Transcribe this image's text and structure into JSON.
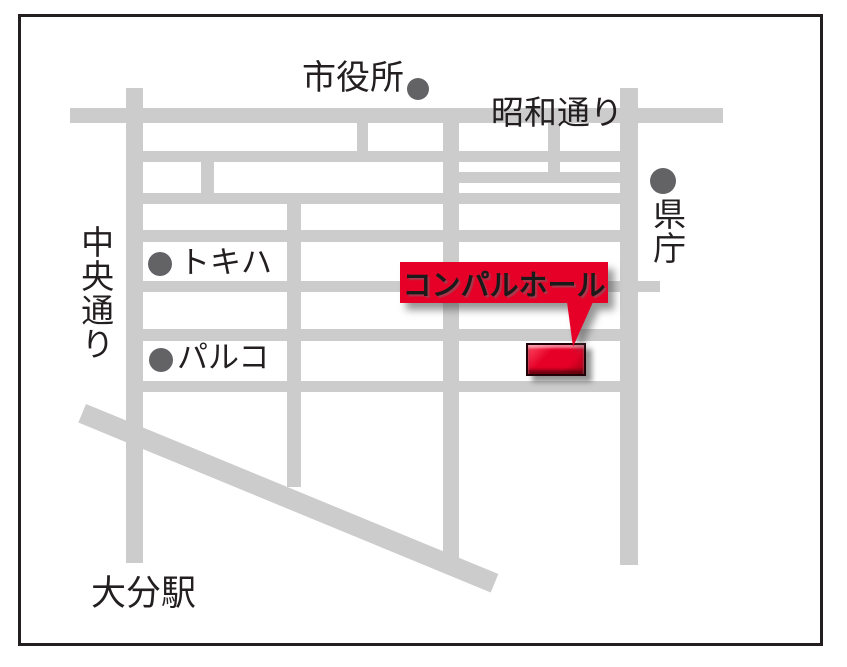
{
  "map": {
    "labels": {
      "city_hall": "市役所",
      "showa_dori": "昭和通り",
      "prefectural_office": "県庁",
      "chuo_dori": "中央通り",
      "tokiwa": "トキハ",
      "parco": "パルコ",
      "destination": "コンパルホール",
      "oita_station": "大分駅"
    },
    "colors": {
      "road": "#cccccc",
      "poi_dot": "#636366",
      "text": "#231f20",
      "accent_red": "#e60028",
      "border": "#231f20",
      "background": "#ffffff"
    }
  }
}
